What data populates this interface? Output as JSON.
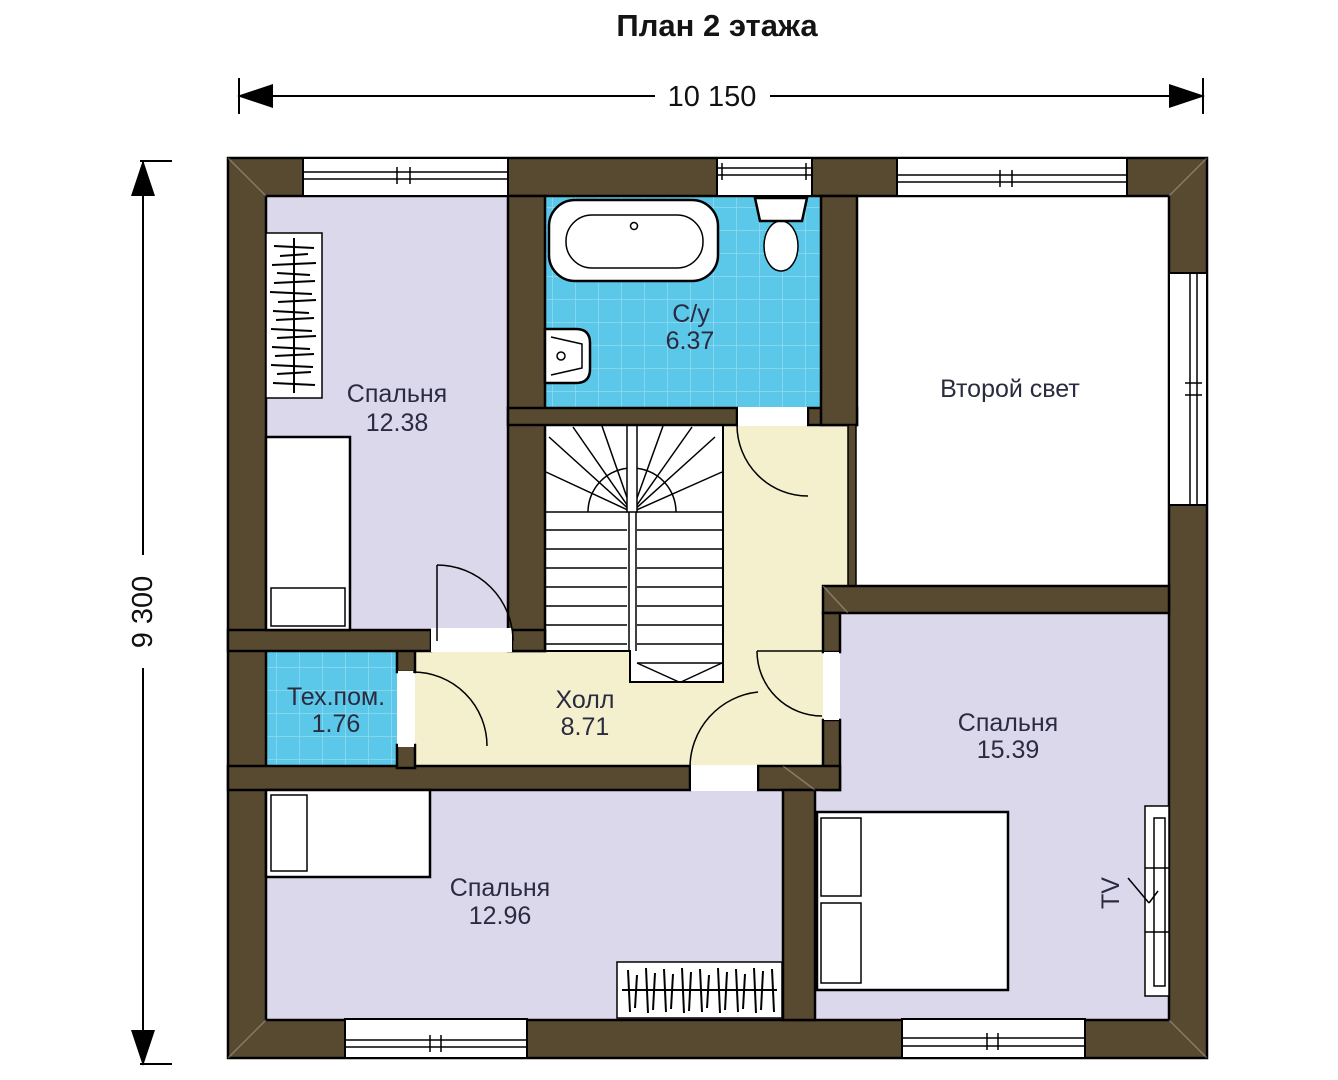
{
  "title": "План 2 этажа",
  "dimensions": {
    "horizontal": "10 150",
    "vertical": "9 300"
  },
  "rooms": {
    "bedroom_top": {
      "name": "Спальня",
      "area": "12.38"
    },
    "bathroom": {
      "name": "С/у",
      "area": "6.37"
    },
    "second_light": {
      "name": "Второй свет",
      "area": ""
    },
    "hall": {
      "name": "Холл",
      "area": "8.71"
    },
    "tech": {
      "name": "Тех.пом.",
      "area": "1.76"
    },
    "bedroom_right": {
      "name": "Спальня",
      "area": "15.39"
    },
    "bedroom_bottom": {
      "name": "Спальня",
      "area": "12.96"
    }
  },
  "labels": {
    "tv": "TV"
  },
  "colors": {
    "wall": "#584a31",
    "bedroom": "#dcd8ec",
    "bathroom": "#5bc8e9",
    "hall": "#f4f0ce",
    "second_light": "#ffffff",
    "label_text": "#2b2b40"
  }
}
